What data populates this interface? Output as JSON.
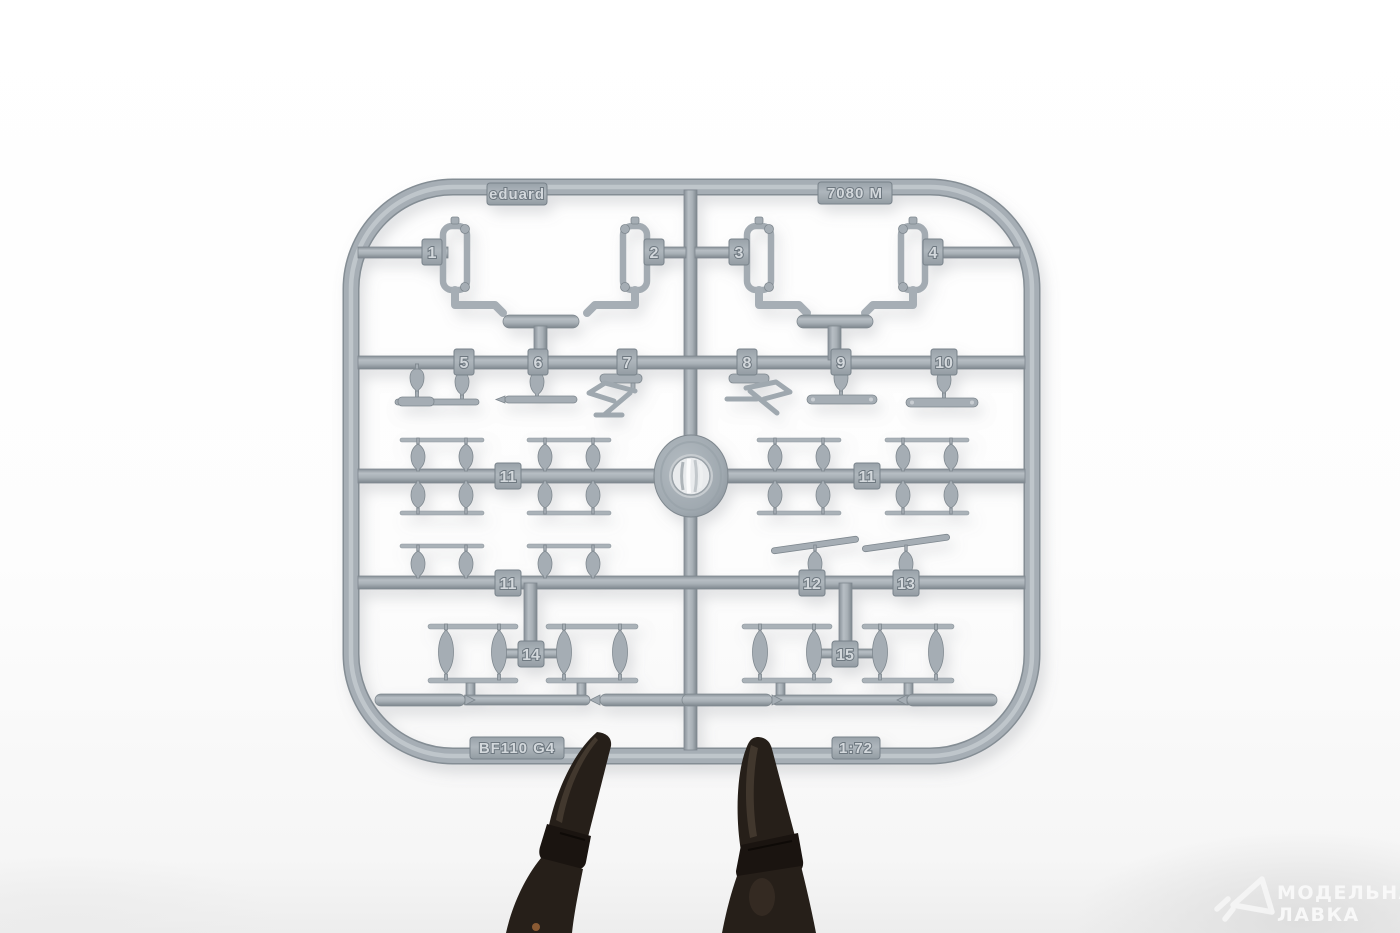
{
  "sprue": {
    "brand_label": "eduard",
    "kit_code_label": "7080 M",
    "aircraft_label": "BF110 G4",
    "scale_label": "1:72",
    "part_numbers": [
      "1",
      "2",
      "3",
      "4",
      "5",
      "6",
      "7",
      "8",
      "9",
      "10",
      "11",
      "11",
      "11",
      "12",
      "13",
      "14",
      "15"
    ],
    "plastic_color": "#a6aeb5",
    "plastic_edge_color": "#7f888f",
    "plastic_highlight_color": "#c2c9ce"
  },
  "clips": {
    "count": 2,
    "color": "#261f19"
  },
  "watermark": {
    "icon": "paper-plane-triangle-icon",
    "line1": "МОДЕЛЬНАЯ",
    "line2": "ЛАВКА",
    "color": "#fafafa"
  },
  "background": {
    "base_color": "#fdfdfd",
    "shadow_color": "#dedede"
  }
}
